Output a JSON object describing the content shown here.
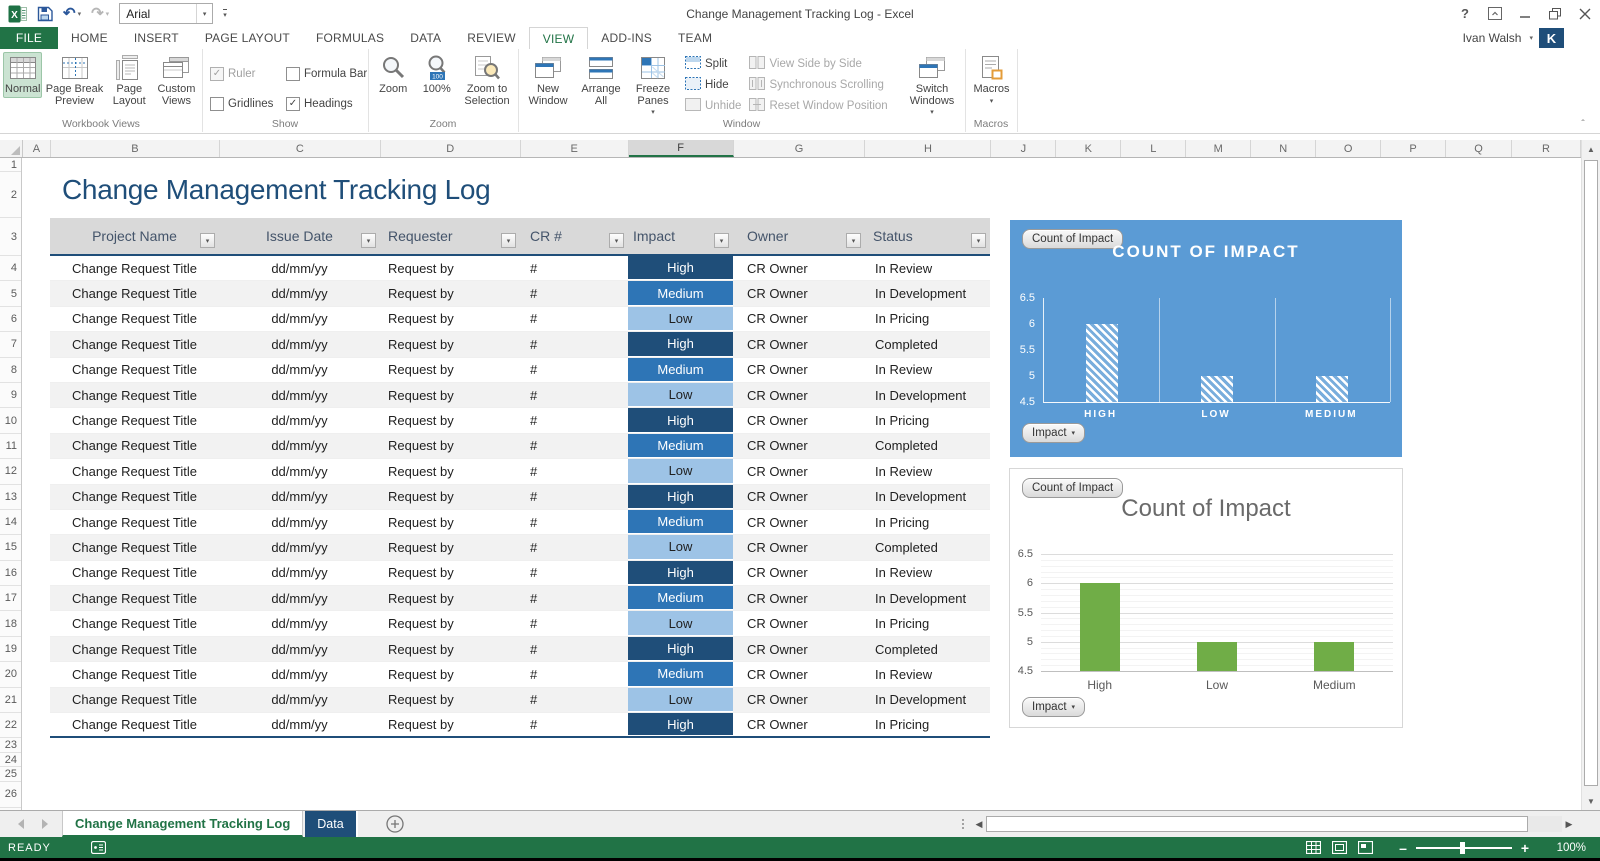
{
  "colors": {
    "accent_green": "#217346",
    "impact_high": "#1F4E79",
    "impact_medium": "#2E75B6",
    "impact_low": "#9DC3E6",
    "table_header_border": "#1F4E79",
    "chart_blue_bg": "#5B9BD5",
    "chart_bar_green": "#70AD47",
    "data_tab_color": "#1F4E79"
  },
  "title_bar": {
    "title": "Change Management Tracking Log - Excel",
    "font_name": "Arial",
    "help": "?"
  },
  "account": {
    "name": "Ivan Walsh",
    "initial": "K"
  },
  "ribbon": {
    "tabs": [
      {
        "label": "FILE",
        "file": true
      },
      {
        "label": "HOME"
      },
      {
        "label": "INSERT"
      },
      {
        "label": "PAGE LAYOUT"
      },
      {
        "label": "FORMULAS"
      },
      {
        "label": "DATA"
      },
      {
        "label": "REVIEW"
      },
      {
        "label": "VIEW",
        "active": true
      },
      {
        "label": "ADD-INS"
      },
      {
        "label": "TEAM"
      }
    ],
    "workbook_views": {
      "label": "Workbook Views",
      "normal": "Normal",
      "page_break": "Page Break Preview",
      "page_layout": "Page Layout",
      "custom_views": "Custom Views"
    },
    "show": {
      "label": "Show",
      "ruler": "Ruler",
      "ruler_checked": true,
      "ruler_disabled": true,
      "gridlines": "Gridlines",
      "gridlines_checked": false,
      "formula_bar": "Formula Bar",
      "formula_bar_checked": false,
      "headings": "Headings",
      "headings_checked": true
    },
    "zoom": {
      "label": "Zoom",
      "zoom": "Zoom",
      "pct": "100%",
      "to_selection": "Zoom to Selection"
    },
    "window": {
      "label": "Window",
      "new_window": "New Window",
      "arrange_all": "Arrange All",
      "freeze_panes": "Freeze Panes",
      "split": "Split",
      "hide": "Hide",
      "unhide": "Unhide",
      "side_by_side": "View Side by Side",
      "sync_scrolling": "Synchronous Scrolling",
      "reset_position": "Reset Window Position",
      "switch_windows": "Switch Windows"
    },
    "macros": {
      "label": "Macros",
      "button": "Macros"
    }
  },
  "sheet": {
    "title": "Change Management Tracking Log",
    "columns": [
      {
        "label": "A"
      },
      {
        "label": "B"
      },
      {
        "label": "C"
      },
      {
        "label": "D"
      },
      {
        "label": "E"
      },
      {
        "label": "F",
        "selected": true
      },
      {
        "label": "G"
      },
      {
        "label": "H"
      },
      {
        "label": "J"
      },
      {
        "label": "K"
      },
      {
        "label": "L"
      },
      {
        "label": "M"
      },
      {
        "label": "N"
      },
      {
        "label": "O"
      },
      {
        "label": "P"
      },
      {
        "label": "Q"
      },
      {
        "label": "R"
      }
    ],
    "row_numbers": [
      "1",
      "2",
      "3",
      "4",
      "5",
      "6",
      "7",
      "8",
      "9",
      "10",
      "11",
      "12",
      "13",
      "14",
      "15",
      "16",
      "17",
      "18",
      "19",
      "20",
      "21",
      "22",
      "23",
      "24",
      "25",
      "26"
    ],
    "table": {
      "headers": [
        "Project Name",
        "Issue Date",
        "Requester",
        "CR #",
        "Impact",
        "Owner",
        "Status"
      ],
      "rows": [
        {
          "project": "Change Request Title",
          "date": "dd/mm/yy",
          "requester": "Request by",
          "cr": "#",
          "impact": "High",
          "owner": "CR Owner",
          "status": "In Review"
        },
        {
          "project": "Change Request Title",
          "date": "dd/mm/yy",
          "requester": "Request by",
          "cr": "#",
          "impact": "Medium",
          "owner": "CR Owner",
          "status": "In Development"
        },
        {
          "project": "Change Request Title",
          "date": "dd/mm/yy",
          "requester": "Request by",
          "cr": "#",
          "impact": "Low",
          "owner": "CR Owner",
          "status": "In Pricing"
        },
        {
          "project": "Change Request Title",
          "date": "dd/mm/yy",
          "requester": "Request by",
          "cr": "#",
          "impact": "High",
          "owner": "CR Owner",
          "status": "Completed"
        },
        {
          "project": "Change Request Title",
          "date": "dd/mm/yy",
          "requester": "Request by",
          "cr": "#",
          "impact": "Medium",
          "owner": "CR Owner",
          "status": "In Review"
        },
        {
          "project": "Change Request Title",
          "date": "dd/mm/yy",
          "requester": "Request by",
          "cr": "#",
          "impact": "Low",
          "owner": "CR Owner",
          "status": "In Development"
        },
        {
          "project": "Change Request Title",
          "date": "dd/mm/yy",
          "requester": "Request by",
          "cr": "#",
          "impact": "High",
          "owner": "CR Owner",
          "status": "In Pricing"
        },
        {
          "project": "Change Request Title",
          "date": "dd/mm/yy",
          "requester": "Request by",
          "cr": "#",
          "impact": "Medium",
          "owner": "CR Owner",
          "status": "Completed"
        },
        {
          "project": "Change Request Title",
          "date": "dd/mm/yy",
          "requester": "Request by",
          "cr": "#",
          "impact": "Low",
          "owner": "CR Owner",
          "status": "In Review"
        },
        {
          "project": "Change Request Title",
          "date": "dd/mm/yy",
          "requester": "Request by",
          "cr": "#",
          "impact": "High",
          "owner": "CR Owner",
          "status": "In Development"
        },
        {
          "project": "Change Request Title",
          "date": "dd/mm/yy",
          "requester": "Request by",
          "cr": "#",
          "impact": "Medium",
          "owner": "CR Owner",
          "status": "In Pricing"
        },
        {
          "project": "Change Request Title",
          "date": "dd/mm/yy",
          "requester": "Request by",
          "cr": "#",
          "impact": "Low",
          "owner": "CR Owner",
          "status": "Completed"
        },
        {
          "project": "Change Request Title",
          "date": "dd/mm/yy",
          "requester": "Request by",
          "cr": "#",
          "impact": "High",
          "owner": "CR Owner",
          "status": "In Review"
        },
        {
          "project": "Change Request Title",
          "date": "dd/mm/yy",
          "requester": "Request by",
          "cr": "#",
          "impact": "Medium",
          "owner": "CR Owner",
          "status": "In Development"
        },
        {
          "project": "Change Request Title",
          "date": "dd/mm/yy",
          "requester": "Request by",
          "cr": "#",
          "impact": "Low",
          "owner": "CR Owner",
          "status": "In Pricing"
        },
        {
          "project": "Change Request Title",
          "date": "dd/mm/yy",
          "requester": "Request by",
          "cr": "#",
          "impact": "High",
          "owner": "CR Owner",
          "status": "Completed"
        },
        {
          "project": "Change Request Title",
          "date": "dd/mm/yy",
          "requester": "Request by",
          "cr": "#",
          "impact": "Medium",
          "owner": "CR Owner",
          "status": "In Review"
        },
        {
          "project": "Change Request Title",
          "date": "dd/mm/yy",
          "requester": "Request by",
          "cr": "#",
          "impact": "Low",
          "owner": "CR Owner",
          "status": "In Development"
        },
        {
          "project": "Change Request Title",
          "date": "dd/mm/yy",
          "requester": "Request by",
          "cr": "#",
          "impact": "High",
          "owner": "CR Owner",
          "status": "In Pricing"
        }
      ]
    }
  },
  "charts": [
    {
      "field_button": "Count of Impact",
      "axis_button": "Impact",
      "style": "blue"
    },
    {
      "field_button": "Count of Impact",
      "axis_button": "Impact",
      "style": "white"
    }
  ],
  "chart_data": [
    {
      "type": "bar",
      "title": "COUNT OF IMPACT",
      "series": "Count of Impact",
      "categories": [
        "HIGH",
        "LOW",
        "MEDIUM"
      ],
      "values": [
        6,
        5,
        5
      ],
      "ylim": [
        4.5,
        6.5
      ],
      "yticks": [
        4.5,
        5,
        5.5,
        6,
        6.5
      ],
      "xlabel": "",
      "ylabel": "",
      "grid": "vertical",
      "legend": "none"
    },
    {
      "type": "bar",
      "title": "Count of Impact",
      "series": "Count of Impact",
      "categories": [
        "High",
        "Low",
        "Medium"
      ],
      "values": [
        6,
        5,
        5
      ],
      "ylim": [
        4.5,
        6.5
      ],
      "yticks": [
        4.5,
        5,
        5.5,
        6,
        6.5
      ],
      "xlabel": "",
      "ylabel": "",
      "grid": "horizontal",
      "legend": "none"
    }
  ],
  "sheet_tabs": {
    "active": "Change Management Tracking Log",
    "data_tab": "Data"
  },
  "status_bar": {
    "mode": "READY",
    "zoom_level": "100%"
  }
}
